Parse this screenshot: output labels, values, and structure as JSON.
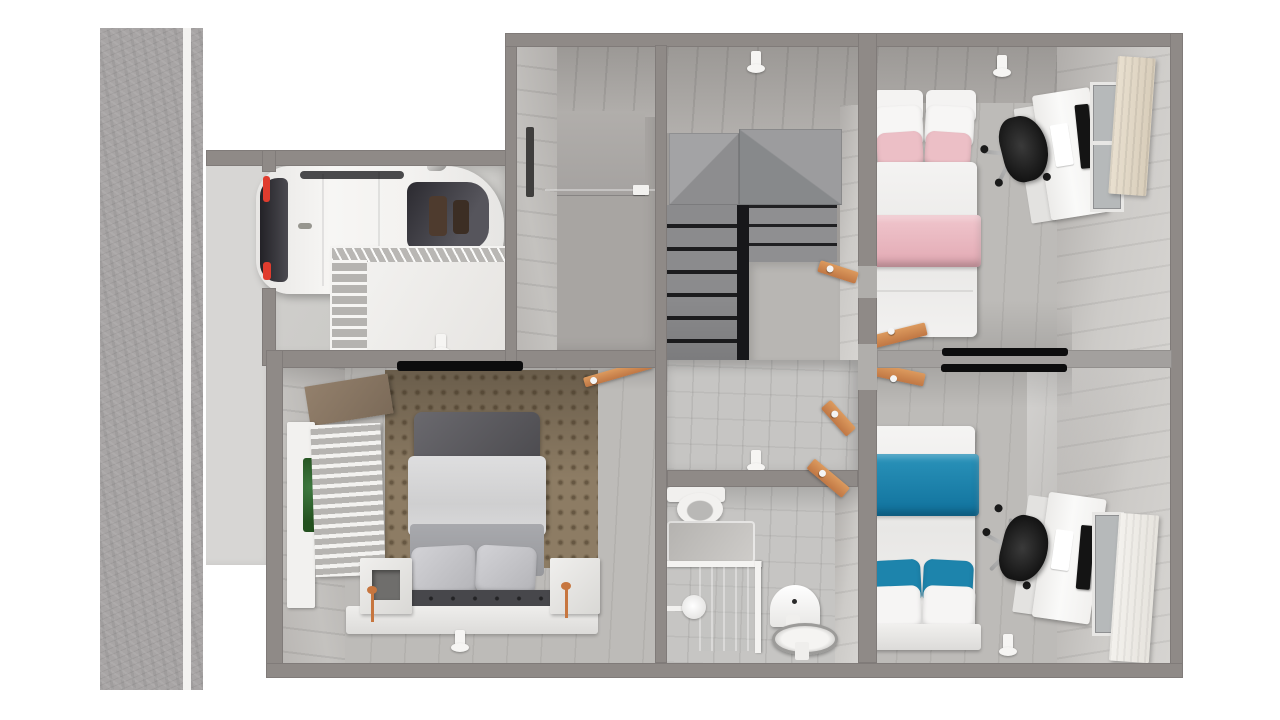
{
  "scene": {
    "type": "3d-floorplan-render",
    "view": "top-down cutaway of a one-storey home with attached garage",
    "text_visible": "none"
  },
  "colors": {
    "bg": "#ffffff",
    "street": "#a8a5a5",
    "street-line": "#f3f2f0",
    "driveway": "#d7d6d4",
    "wall": "#8f8a87",
    "floor": "#bdbbb8",
    "tile": "#c6c5c3",
    "fixture": "#f6f5f3",
    "knob": "#f4f4f4",
    "pink": "#ecbfc6",
    "pink-dark": "#e0a6b0",
    "teal": "#1d84ac",
    "teal-dark": "#10719c",
    "white-fabric": "#f3f2f1",
    "orange-door": "#d08a54",
    "copper": "#c7763f",
    "car-body": "#f4f3f2",
    "car-glass": "#34333a",
    "car-red": "#e03c2e",
    "headboard-dark": "#57565a",
    "bench-dark": "#47474b",
    "monitor": "#141414",
    "chair": "#1f1f1f",
    "foliage": "#2e5d33"
  },
  "exterior": {
    "street": {
      "orientation": "vertical",
      "lanes": 2,
      "marking": "solid white edge line"
    },
    "driveway": {
      "position": "left of garage"
    }
  },
  "rooms": [
    {
      "id": "garage",
      "name": "Garage",
      "furniture": [
        "white SUV parked facing right",
        "wire shelving rack",
        "ceiling light"
      ]
    },
    {
      "id": "entry-closet",
      "name": "Entry / storage room",
      "furniture": [
        "wall slot window",
        "wall panel",
        "light switch"
      ]
    },
    {
      "id": "stair-hall",
      "name": "Staircase hall",
      "furniture": [
        "L-shaped winder staircase",
        "landing",
        "ceiling light"
      ]
    },
    {
      "id": "hallway",
      "name": "Hallway",
      "furniture": [
        "ceiling light",
        "open wooden doors"
      ]
    },
    {
      "id": "bathroom",
      "name": "Bathroom",
      "furniture": [
        "toilet",
        "bathtub with glass screen",
        "shower head",
        "washbasin",
        "pedestal basin",
        "open wooden door"
      ]
    },
    {
      "id": "bedroom-pink",
      "name": "Bedroom (pink bedding)",
      "furniture": [
        "single bed with pink blanket and pillows",
        "white desk with monitor",
        "black office chair",
        "window with tan curtain",
        "wall tv",
        "ceiling light",
        "open wooden door"
      ]
    },
    {
      "id": "bedroom-blue",
      "name": "Bedroom (blue bedding)",
      "furniture": [
        "single bed with teal blanket and pillows",
        "white desk with monitor",
        "black office chair",
        "window with white curtain",
        "wall tv",
        "ceiling light",
        "open wooden door"
      ]
    },
    {
      "id": "bedroom-master",
      "name": "Master bedroom",
      "furniture": [
        "double bed with dark headboard and tufted bench",
        "patterned accent wallpaper wall",
        "two nightstands with copper lamps",
        "window with blinds and greenery",
        "brown valance",
        "wall tv",
        "ceiling light",
        "open wooden door"
      ]
    }
  ]
}
